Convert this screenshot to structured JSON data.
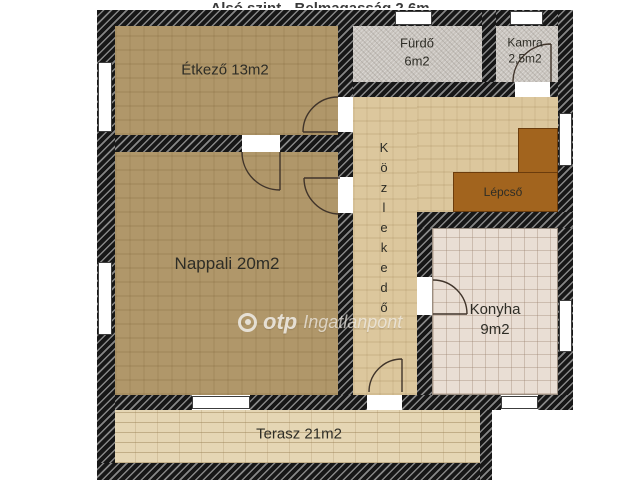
{
  "title": "Alsó szint - Belmagasság 2,6m",
  "rooms": {
    "etkezo": {
      "label": "Étkező 13m2"
    },
    "furdo": {
      "name": "Fürdő",
      "area": "6m2"
    },
    "kamra": {
      "name": "Kamra",
      "area": "2,5m2"
    },
    "kozlekedo": {
      "label": "Közlekedő"
    },
    "lepcso": {
      "label": "Lépcső"
    },
    "nappali": {
      "label": "Nappali 20m2"
    },
    "konyha": {
      "name": "Konyha",
      "area": "9m2"
    },
    "terasz": {
      "label": "Terasz 21m2"
    }
  },
  "watermark": {
    "brand": "otp",
    "suffix": "Ingatlanpont"
  },
  "colors": {
    "wall": "#171717",
    "carpet_floor": "#b0976a",
    "hallway_floor": "#dcc79d",
    "bathroom_floor": "#c9c4be",
    "kitchen_floor": "#e9ded4",
    "terrace_floor": "#e5d6b4",
    "stairs": "#a2641e",
    "window": "#ffffff",
    "label_text": "#2e2d26"
  }
}
